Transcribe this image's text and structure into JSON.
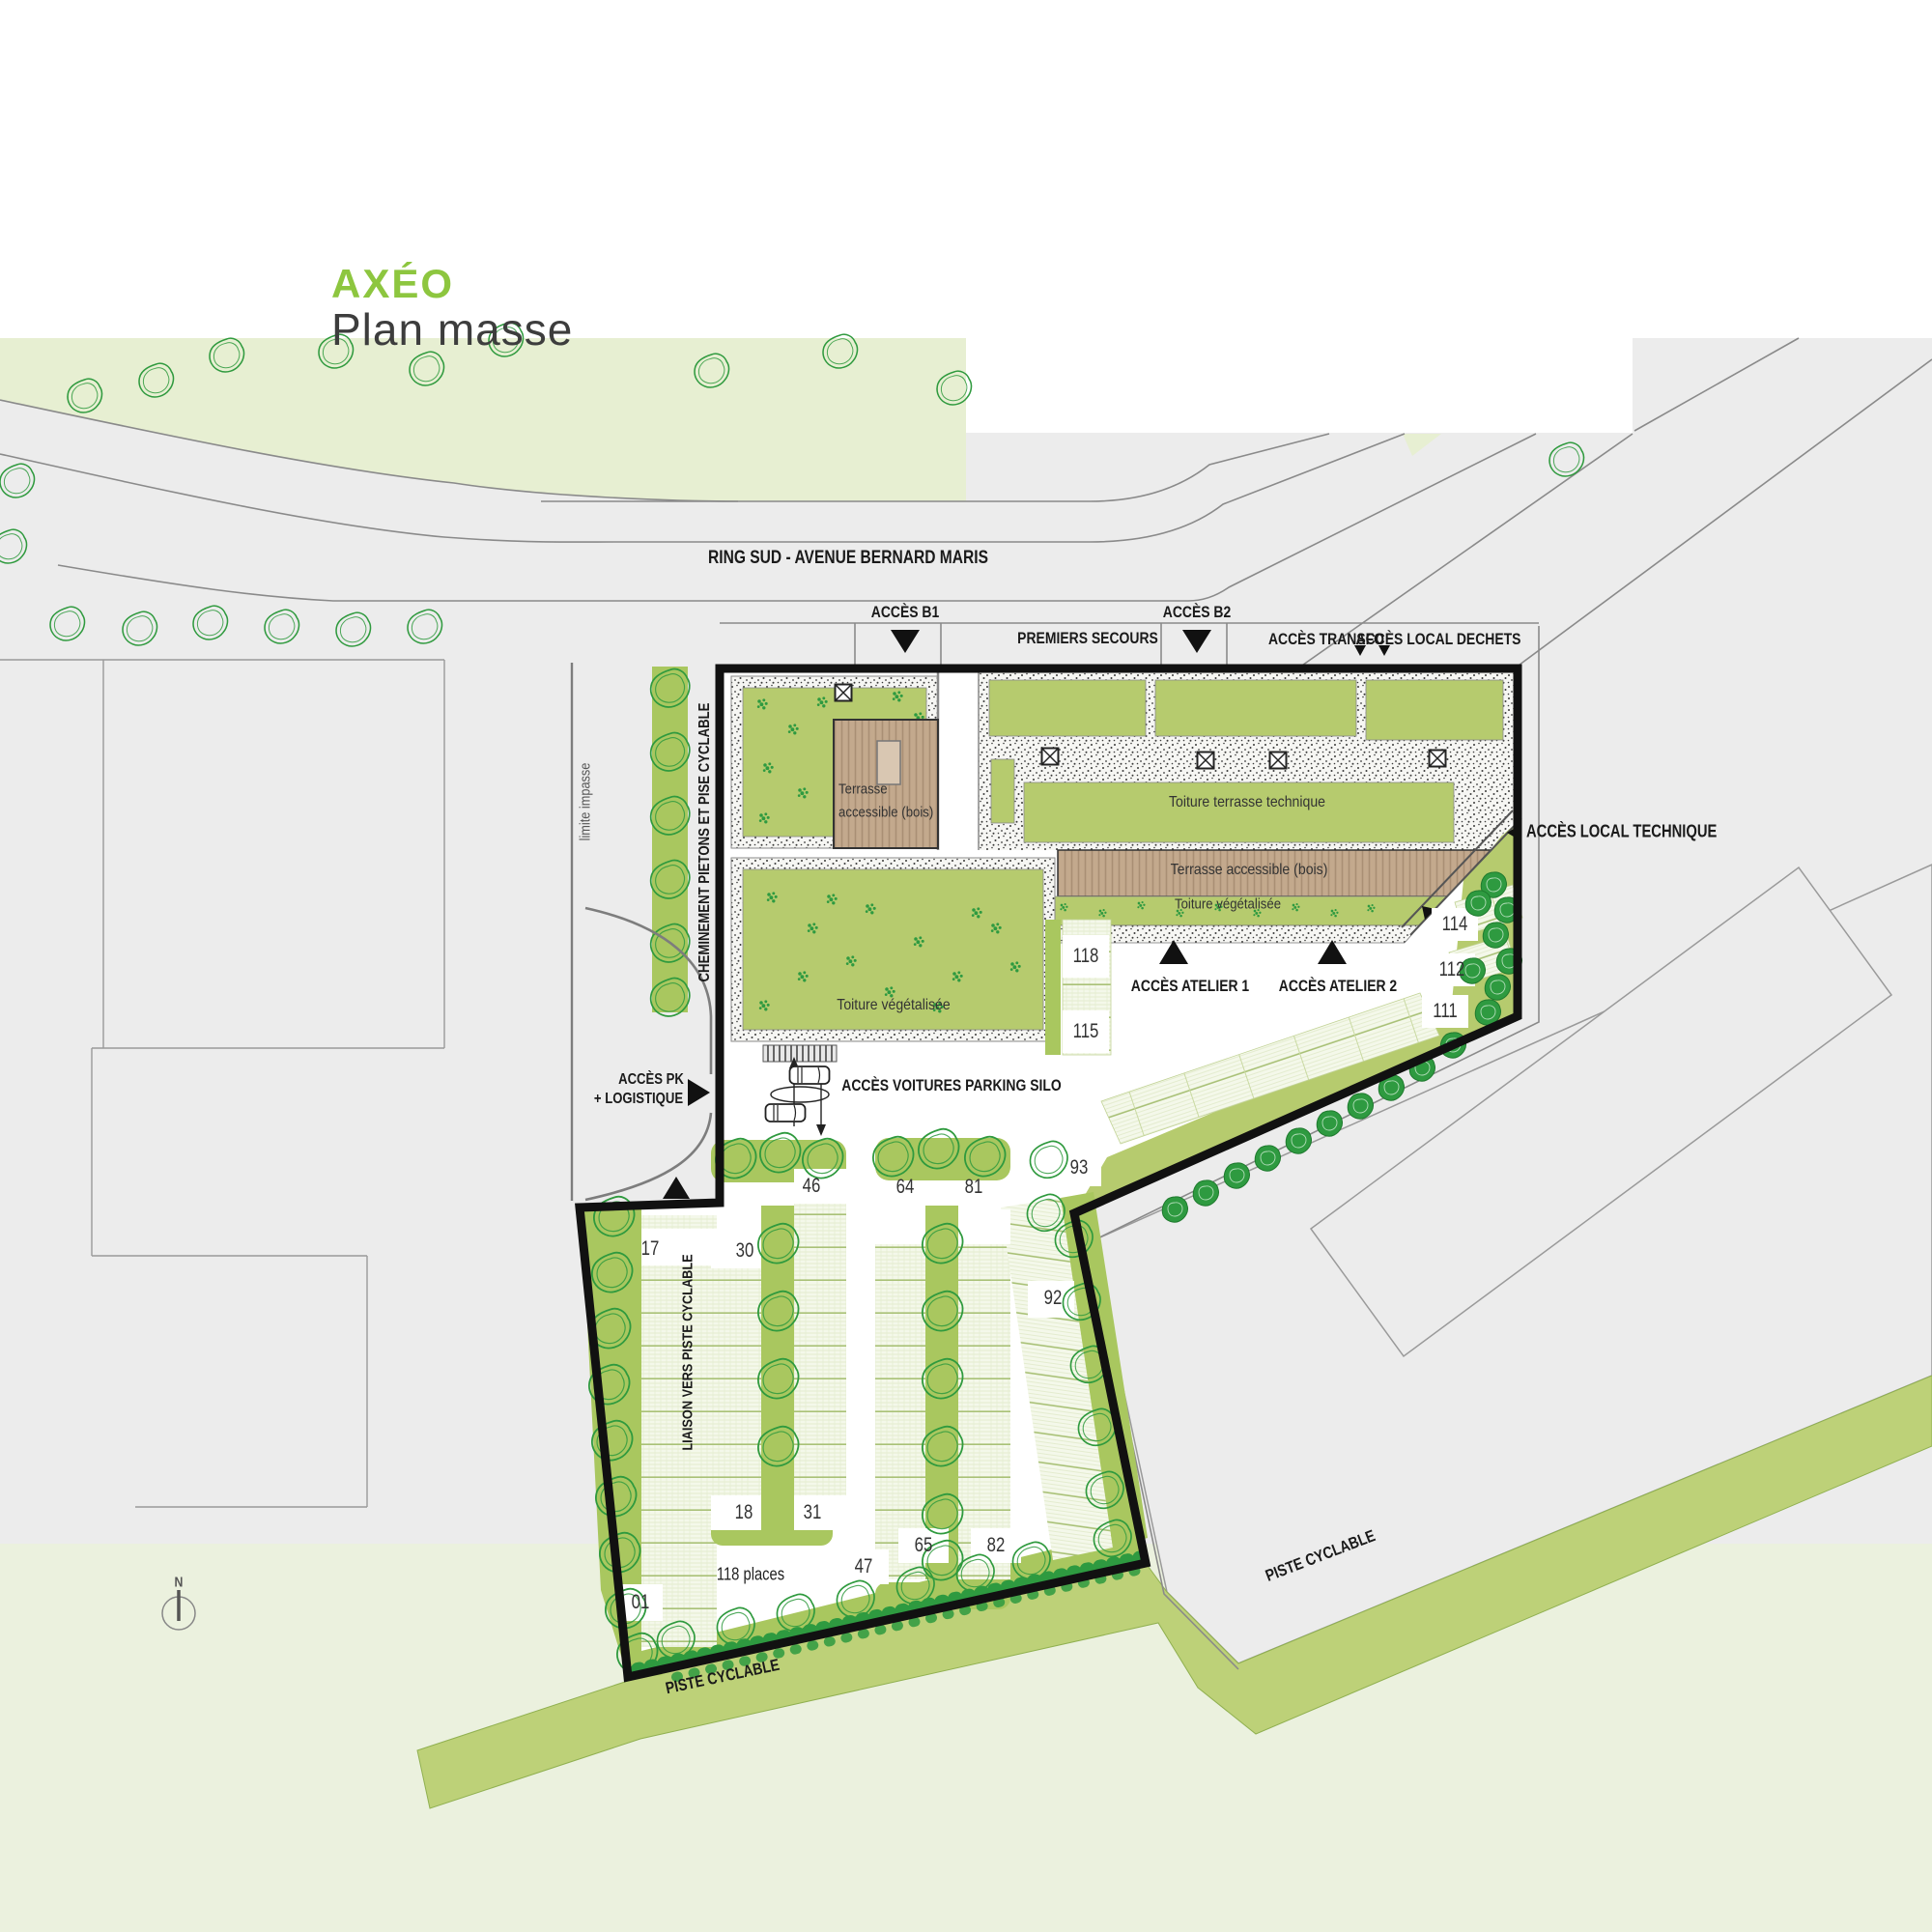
{
  "title": {
    "brand": "AXÉO",
    "subtitle": "Plan masse"
  },
  "streets": {
    "main": "RING SUD - AVENUE BERNARD MARIS",
    "piste_sw": "PISTE CYCLABLE",
    "piste_se": "PISTE CYCLABLE"
  },
  "access": {
    "b1": "ACCÈS B1",
    "b2": "ACCÈS B2",
    "premiers_secours": "PREMIERS SECOURS",
    "transfo": "ACCÈS TRANSFO",
    "local_dechets": "ACCÈS LOCAL DECHETS",
    "local_technique": "ACCÈS LOCAL TECHNIQUE",
    "atelier_1": "ACCÈS ATELIER 1",
    "atelier_2": "ACCÈS ATELIER 2",
    "pk_line1": "ACCÈS PK",
    "pk_line2": "+ LOGISTIQUE",
    "voitures": "ACCÈS VOITURES PARKING SILO"
  },
  "roofs": {
    "terrasse_nord_1": "Terrasse",
    "terrasse_nord_2": "accessible (bois)",
    "technique": "Toiture terrasse technique",
    "terrasse_sud": "Terrasse accessible (bois)",
    "veg_bande": "Toiture végétalisée",
    "veg_ouest": "Toiture végétalisée"
  },
  "paths": {
    "limite": "limite impasse",
    "cheminement": "CHEMINEMENT PIETONS ET PISE CYCLABLE",
    "liaison": "LIAISON VERS PISTE CYCLABLE"
  },
  "parking": {
    "places": "118 places",
    "spots": {
      "s118": "118",
      "s115": "115",
      "s114": "114",
      "s112": "112",
      "s111": "111",
      "s93": "93",
      "s92": "92",
      "s46": "46",
      "s64": "64",
      "s81": "81",
      "s17": "17",
      "s30": "30",
      "s18": "18",
      "s31": "31",
      "s47": "47",
      "s65": "65",
      "s82": "82",
      "s01": "01"
    }
  },
  "north": "N",
  "colors": {
    "brand_green": "#8dc63f",
    "roof_green": "#b6cb6e",
    "strip_green": "#a9c75f",
    "pale_green_north": "#e7efd2",
    "pale_green_south": "#ebf1de",
    "bike_band_green": "#bdd178",
    "context_gray": "#ececec",
    "wood_brown": "#c3a98d",
    "tree_green": "#2f9a3e",
    "boundary_black": "#111111"
  }
}
